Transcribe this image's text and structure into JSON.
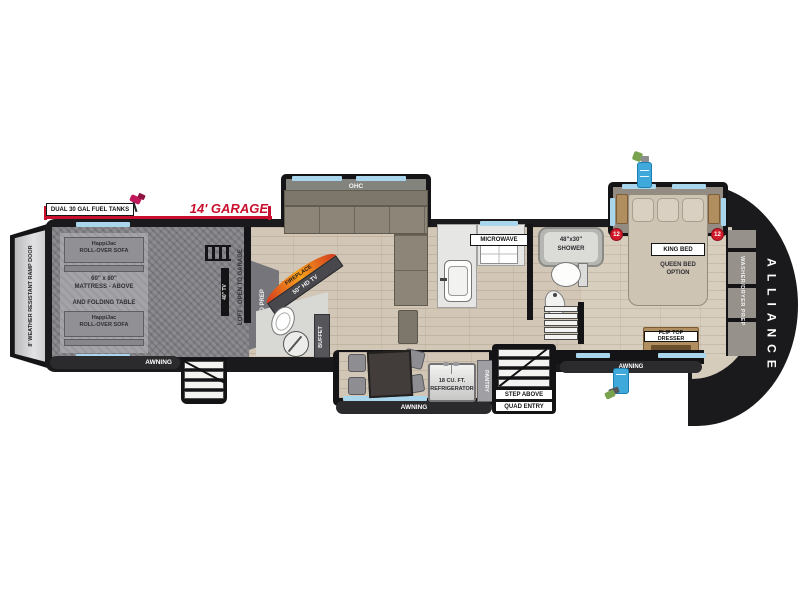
{
  "plan": {
    "brand": "ALLIANCE",
    "awning": "AWNING",
    "garage": {
      "fuel_label": "DUAL 30 GAL FUEL TANKS",
      "length_label": "14' GARAGE",
      "ramp_label": "8' WEATHER RESISTANT RAMP DOOR",
      "sofa_line1": "HappiJac",
      "sofa_line2": "ROLL-OVER SOFA",
      "mattress_line1": "60\" x 80\"",
      "mattress_line2": "MATTRESS - ABOVE",
      "mattress_line3": "AND FOLDING TABLE",
      "tv": "40\" TV",
      "loft": "LOFT - OPEN TO GARAGE",
      "wd_prep": "W/D PREP"
    },
    "living": {
      "ohc": "OHC",
      "fireplace": "FIREPLACE",
      "tv": "50\" HD TV",
      "buffet": "BUFFET",
      "microwave": "MICROWAVE",
      "fridge_line1": "18 CU. FT.",
      "fridge_line2": "REFRIGERATOR",
      "pantry": "PANTRY",
      "entry_line1": "STEP ABOVE",
      "entry_line2": "QUAD ENTRY"
    },
    "bath": {
      "shower_line1": "48\"x30\"",
      "shower_line2": "SHOWER"
    },
    "bedroom": {
      "bed": "KING BED",
      "option_line1": "QUEEN BED",
      "option_line2": "OPTION",
      "dresser": "FLIP TOP DRESSER",
      "wd_prep": "WASHER/DRYER PREP",
      "marker": "12"
    },
    "icons": {
      "fuel_pump": "fuel-pump",
      "water_heater": "tankless-water-heater",
      "outdoor_shower": "outdoor-shower"
    },
    "colors": {
      "accent_red": "#c8102e",
      "window_blue": "#a9d6ec",
      "body_black": "#1a1a1c",
      "wood_floor": "#d2c7b6",
      "garage_gray": "#8b8b90",
      "icon_blue": "#3fa9dc"
    }
  }
}
